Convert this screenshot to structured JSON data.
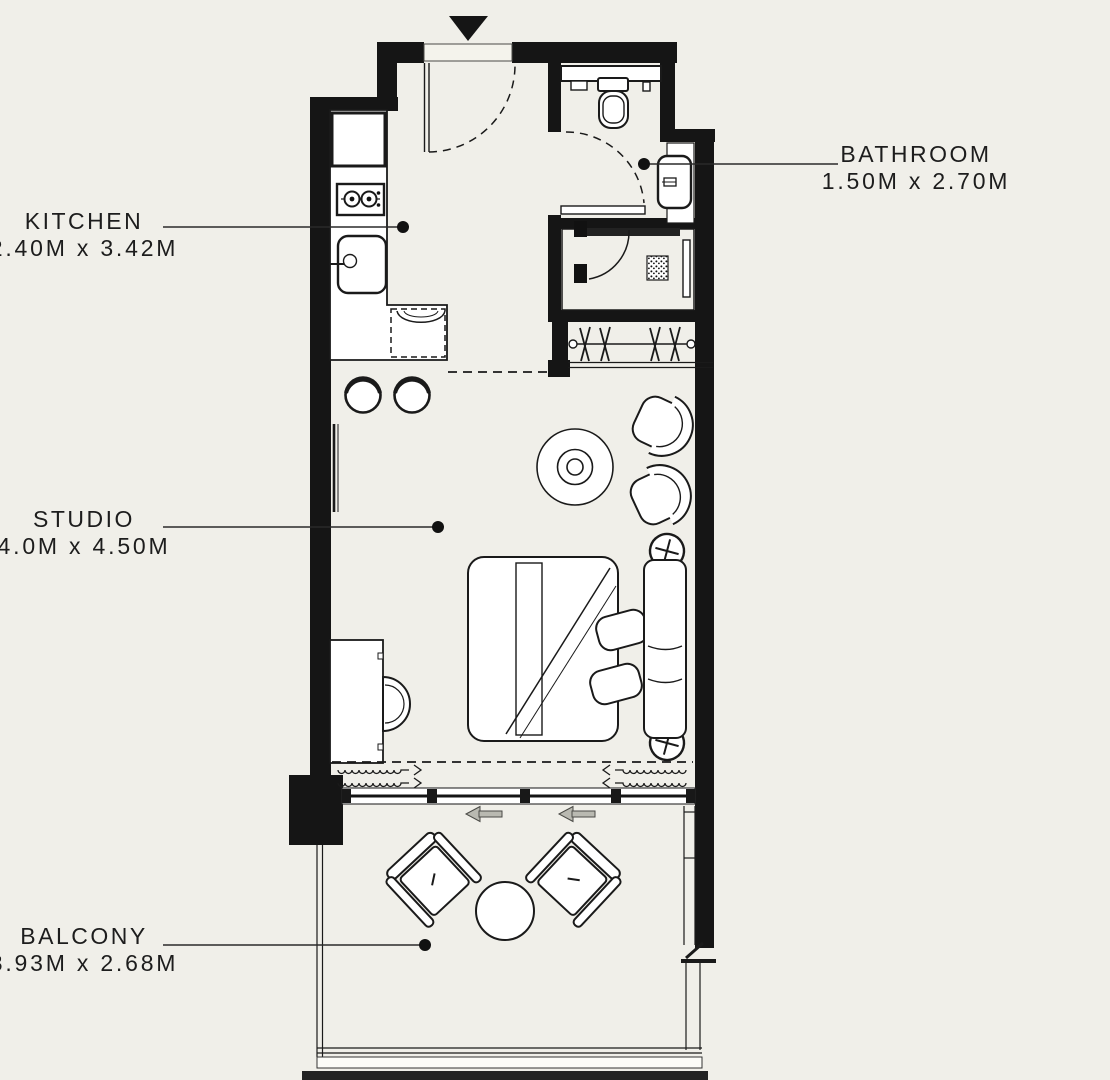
{
  "title": "Studio apartment floor plan",
  "palette": {
    "background": "#f0efe9",
    "wall": "#151515",
    "fixture_fill": "#ffffff",
    "line": "#1a1a1a",
    "arrow_gray": "#b9b9b1"
  },
  "labels": {
    "kitchen": {
      "name": "KITCHEN",
      "dims": "2.40M x 3.42M"
    },
    "bathroom": {
      "name": "BATHROOM",
      "dims": "1.50M x 2.70M"
    },
    "studio": {
      "name": "STUDIO",
      "dims": "4.0M x 4.50M"
    },
    "balcony": {
      "name": "BALCONY",
      "dims": "3.93M x 2.68M"
    }
  },
  "icons": {
    "entry_marker": "triangle-down",
    "slide_direction": "arrow-left"
  }
}
